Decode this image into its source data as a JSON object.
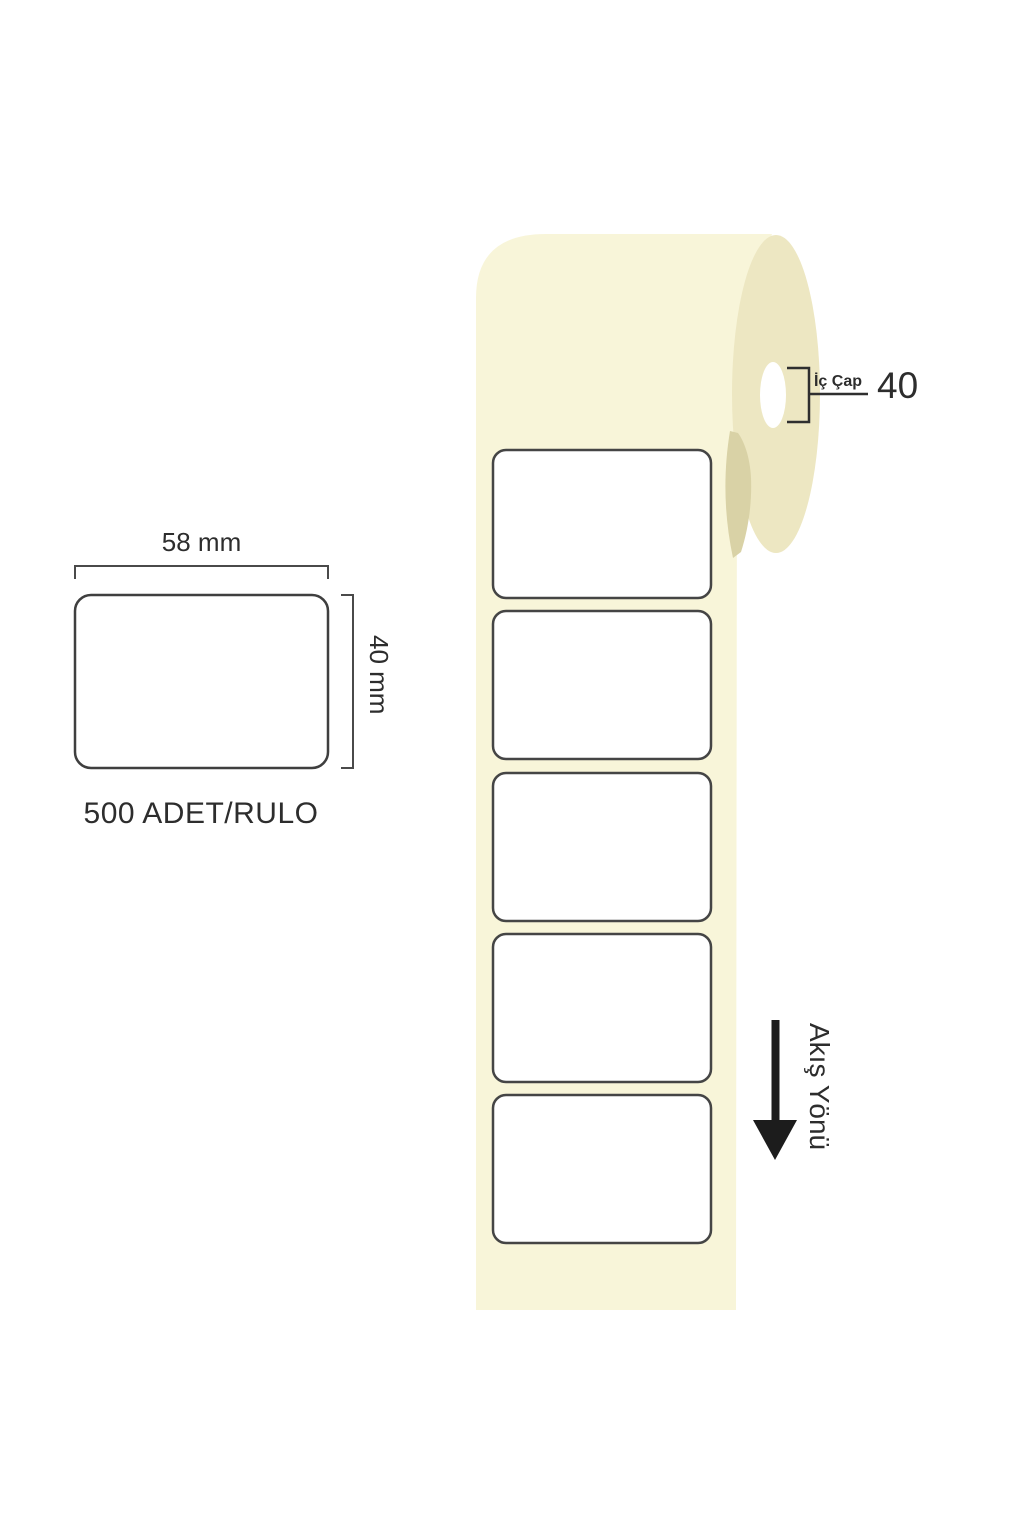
{
  "page": {
    "background": "#ffffff",
    "description_labels": {
      "width_label": "58 mm",
      "height_label": "40 mm",
      "per_roll_label": "500 ADET/RULO"
    }
  },
  "roll": {
    "core_dim_label": "İç Çap",
    "core_dim_value": "40",
    "labels_visible_count": 5,
    "colors": {
      "front": "#F8F5D9",
      "side": "#EDE7C2",
      "shadow": "#D9D2A6",
      "hole": "#FFFFFF",
      "label_fill": "#FFFFFF",
      "label_border": "#454545"
    }
  },
  "flow": {
    "direction_label": "Akış Yönü",
    "arrow_color": "#1C1C1C"
  },
  "lines": {
    "dimension_stroke": "#4A4A4A",
    "text_color": "#2D2D2D"
  }
}
